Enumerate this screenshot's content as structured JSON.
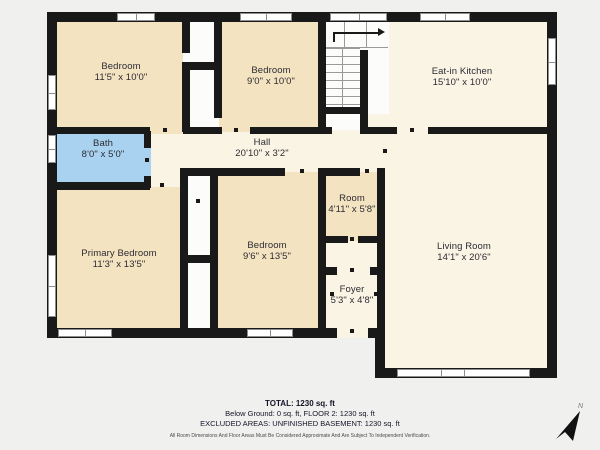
{
  "palette": {
    "background": "#f0f0ef",
    "wall": "#191919",
    "cream": "#faf4e4",
    "tan": "#f4e3c0",
    "bath_blue": "#a9d2f0",
    "stair_white": "#fcfcfa",
    "label_text": "#2b2b33"
  },
  "floorplan": {
    "rooms": [
      {
        "name": "Bedroom",
        "dims": "11'5\" x 10'0\""
      },
      {
        "name": "Bedroom",
        "dims": "9'0\" x 10'0\""
      },
      {
        "name": "Eat-in Kitchen",
        "dims": "15'10\" x 10'0\""
      },
      {
        "name": "Bath",
        "dims": "8'0\" x 5'0\""
      },
      {
        "name": "Hall",
        "dims": "20'10\" x 3'2\""
      },
      {
        "name": "Primary Bedroom",
        "dims": "11'3\" x 13'5\""
      },
      {
        "name": "Bedroom",
        "dims": "9'6\" x 13'5\""
      },
      {
        "name": "Room",
        "dims": "4'11\" x 5'8\""
      },
      {
        "name": "Foyer",
        "dims": "5'3\" x 4'8\""
      },
      {
        "name": "Living Room",
        "dims": "14'1\" x 20'6\""
      }
    ],
    "compass": {
      "label": "N"
    }
  },
  "footer": {
    "total": "TOTAL: 1230 sq. ft",
    "line2": "Below Ground: 0 sq. ft, FLOOR 2: 1230 sq. ft",
    "line3": "EXCLUDED AREAS: UNFINISHED BASEMENT: 1230 sq. ft",
    "disclaimer": "All Room Dimensions And Floor Areas Must Be Considered Approximate And Are Subject To Independent Verification."
  }
}
